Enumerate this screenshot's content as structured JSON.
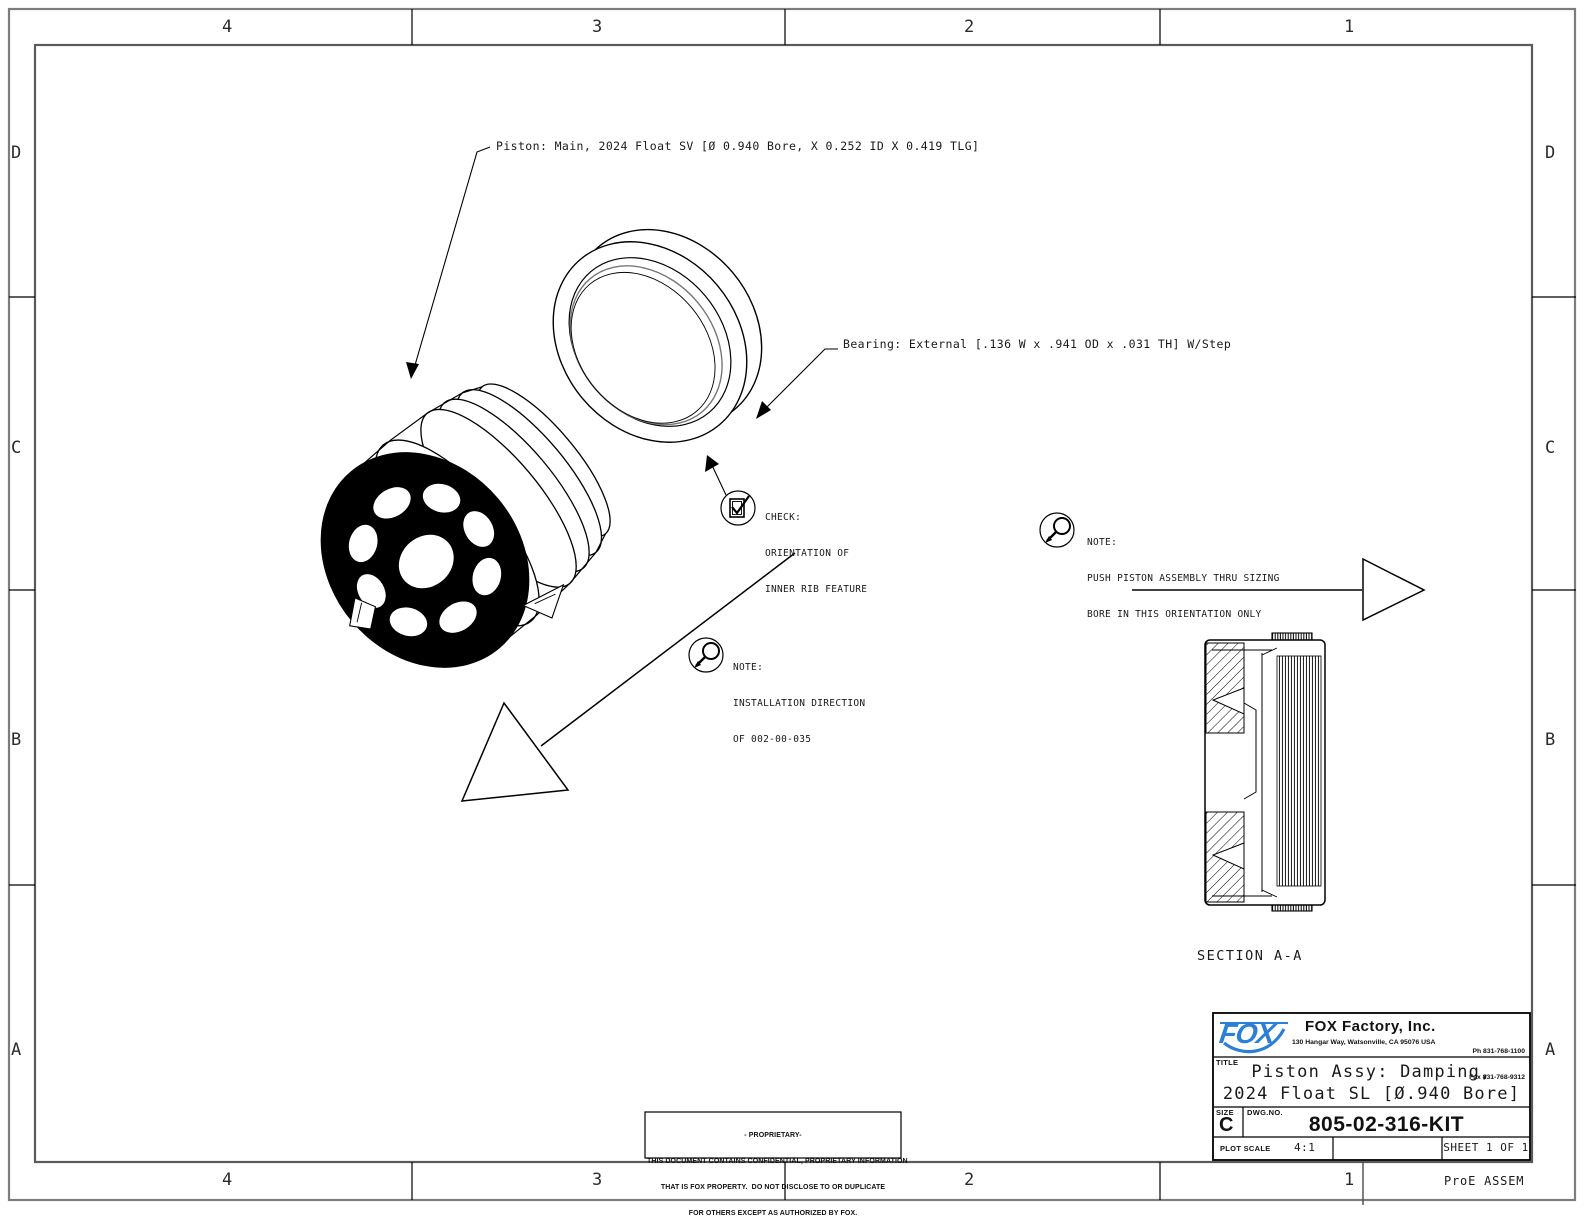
{
  "drawing": {
    "zones": {
      "columns": [
        "4",
        "3",
        "2",
        "1"
      ],
      "rows": [
        "D",
        "C",
        "B",
        "A"
      ]
    },
    "callouts": {
      "piston": "Piston: Main, 2024 Float SV [Ø 0.940 Bore, X 0.252 ID X 0.419 TLG]",
      "bearing": "Bearing: External [.136 W x .941 OD x .031 TH] W/Step"
    },
    "check_note": {
      "label": "CHECK:",
      "line1": "ORIENTATION OF",
      "line2": "INNER RIB FEATURE"
    },
    "note_push": {
      "label": "NOTE:",
      "line1": "PUSH PISTON ASSEMBLY THRU SIZING",
      "line2": "BORE IN THIS ORIENTATION ONLY"
    },
    "note_install": {
      "label": "NOTE:",
      "line1": "INSTALLATION DIRECTION",
      "line2": "OF 002-00-035"
    },
    "section_label": "SECTION A-A"
  },
  "title_block": {
    "logo_text": "FOX",
    "logo_color": "#2b7fd6",
    "company": "FOX Factory, Inc.",
    "address": "130 Hangar Way, Watsonville, CA 95076 USA",
    "phone": "Ph 831-768-1100",
    "fax": "Fax 831-768-9312",
    "title_label": "TITLE",
    "title_line1": "Piston Assy: Damping,",
    "title_line2": "2024 Float SL [Ø.940 Bore]",
    "size_label": "SIZE",
    "size_value": "C",
    "dwg_label": "DWG.NO.",
    "dwg_number": "805-02-316-KIT",
    "plot_scale_label": "PLOT SCALE",
    "plot_scale_value": "4:1",
    "sheet_label": "SHEET 1 OF 1"
  },
  "proprietary": {
    "line1": "- PROPRIETARY-",
    "line2": "THIS DOCUMENT CONTAINS CONFIDENTIAL, PROPRIETARY INFORMATION",
    "line3": "THAT IS FOX PROPERTY.  DO NOT DISCLOSE TO OR DUPLICATE",
    "line4": "FOR OTHERS EXCEPT AS AUTHORIZED BY FOX."
  },
  "footer": {
    "cad_note": "ProE ASSEM"
  }
}
